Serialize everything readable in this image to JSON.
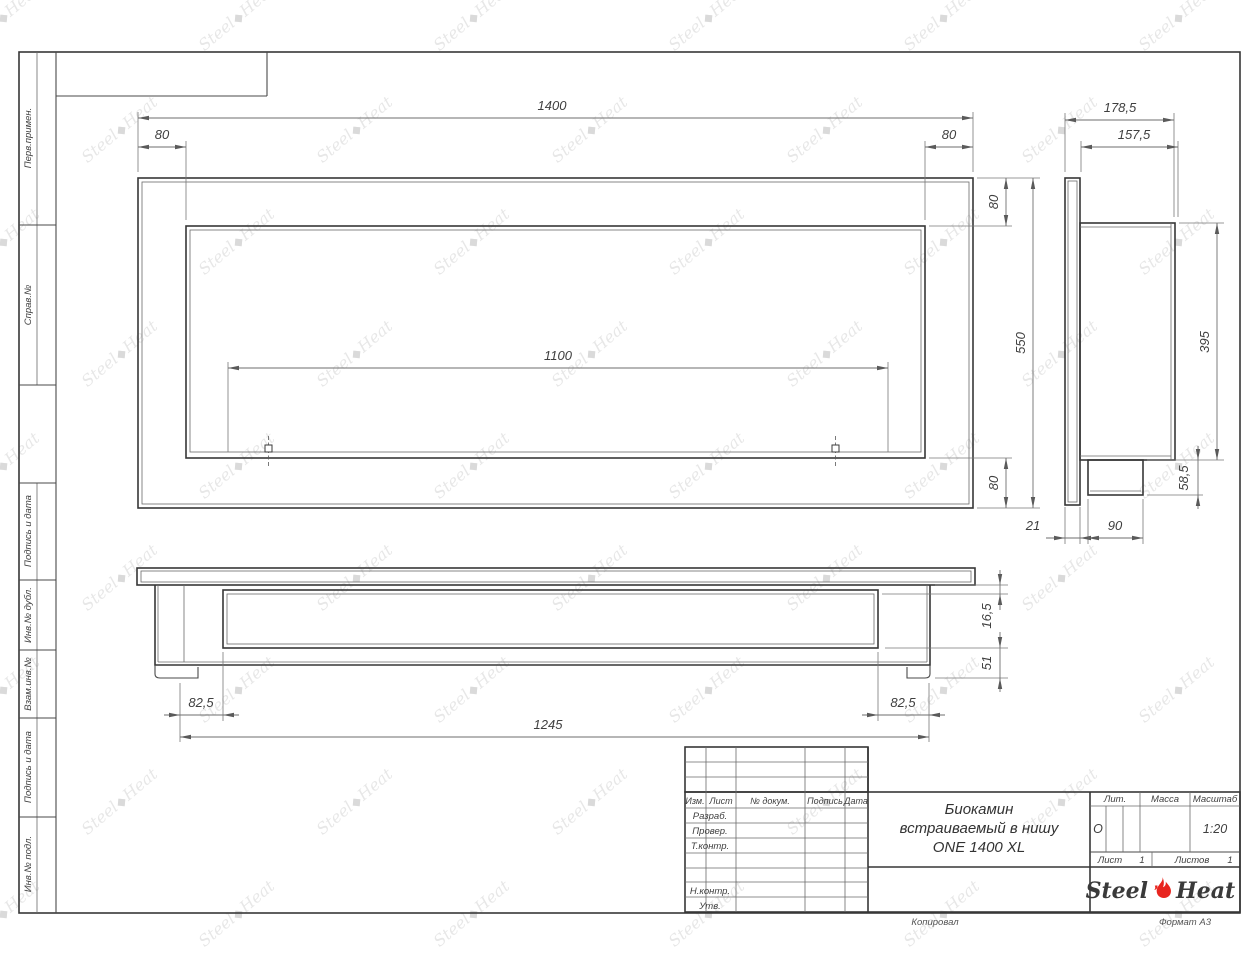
{
  "frame": {
    "side_labels": [
      "Перв.примен.",
      "Справ.№",
      "Подпись и дата",
      "Инв.№ дубл.",
      "Взам.инв.№",
      "Подпись и дата",
      "Инв.№ подл."
    ],
    "footer": {
      "copied": "Копировал",
      "format": "Формат А3"
    }
  },
  "dims": {
    "front": {
      "total_width": "1400",
      "margin_left": "80",
      "margin_right": "80",
      "opening_width": "1100",
      "total_height": "550",
      "margin_top": "80",
      "margin_bottom": "80"
    },
    "side": {
      "total_depth": "178,5",
      "inner_depth": "157,5",
      "body_height": "395",
      "tray_height": "58,5",
      "flange": "21",
      "tray_depth": "90"
    },
    "bottom": {
      "inset_left": "82,5",
      "inset_right": "82,5",
      "niche_length": "1245",
      "plate_gap": "16,5",
      "foot_height": "51"
    }
  },
  "stamp": {
    "header_cols": {
      "izm": "Изм.",
      "list": "Лист",
      "doc": "№ докум.",
      "sign": "Подпись",
      "date": "Дата"
    },
    "approval_rows": {
      "dev": "Разраб.",
      "check": "Провер.",
      "tcontr": "Т.контр.",
      "ncontr": "Н.контр.",
      "approve": "Утв."
    },
    "title_line1": "Биокамин",
    "title_line2": "встраиваемый в нишу",
    "title_line3": "ONE 1400 XL",
    "lit_label": "Лит.",
    "lit_value": "О",
    "mass_label": "Масса",
    "scale_label": "Масштаб",
    "scale_value": "1:20",
    "sheet_label": "Лист",
    "sheet_num": "1",
    "sheets_label": "Листов",
    "sheets_num": "1",
    "logo_left": "Steel",
    "logo_right": "Heat"
  },
  "watermark": {
    "left": "Steel",
    "right": "Heat",
    "icon_glyph": "◆"
  },
  "colors": {
    "line": "#373737",
    "accent_red": "#e8251f",
    "watermark": "rgba(70,70,70,0.13)"
  }
}
